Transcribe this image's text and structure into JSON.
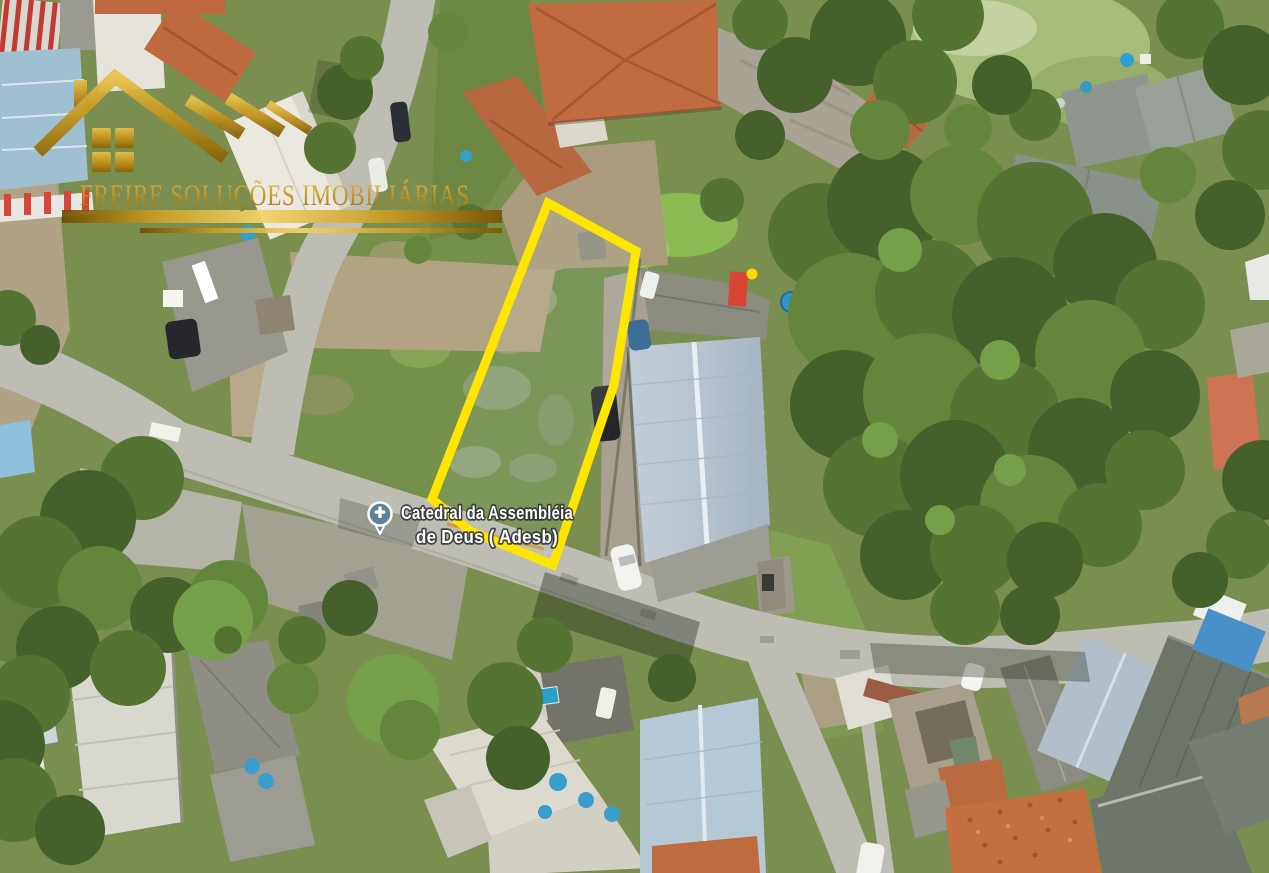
{
  "watermark": {
    "company_name": "FREIRE SOLUÇÕES IMOBILIÁRIAS",
    "icon": "gold-house-logo-icon"
  },
  "place_label": {
    "line1": "Catedral da Assembléia",
    "line2": "de Deus ( Adesb)",
    "icon": "church-pin-icon"
  },
  "parcel_highlight": {
    "shape": "yellow-outlined-lot-boundary",
    "marker": "small-yellow-dot"
  },
  "colors": {
    "parcel_outline": "#ffe600",
    "parcel_marker_dot": "#ffd800",
    "pin_fill": "#5e8398",
    "label_text": "#ffffff",
    "logo_gold": "#c8961e",
    "road": "#bdbdb3",
    "vegetation": "#7a8e4f",
    "terracotta_roof": "#c16b41",
    "warehouse_roof": "#b7c3ce"
  }
}
